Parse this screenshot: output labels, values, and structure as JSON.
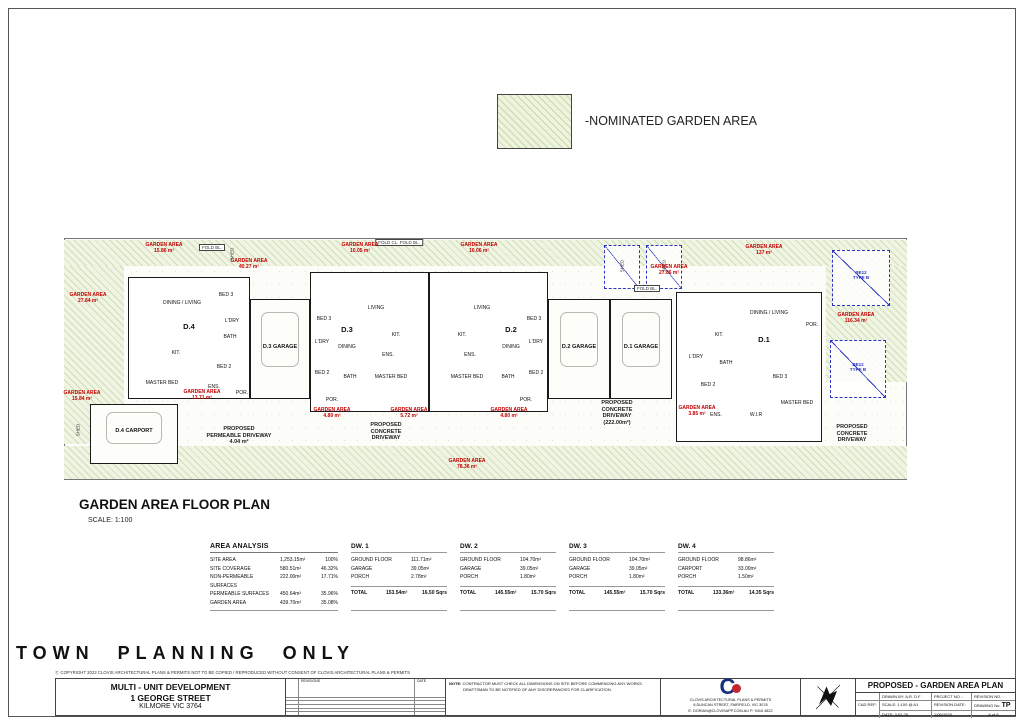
{
  "colors": {
    "garden_hatch": "#eef3e0",
    "hatch_line": "#c7d8a6",
    "label_red": "#c40000",
    "dash_blue": "#2b35c0",
    "wall": "#1a1a1a",
    "logo_navy": "#1b2d7e",
    "logo_red": "#c2262e"
  },
  "legend": {
    "label": "-NOMINATED GARDEN AREA"
  },
  "plan": {
    "heading": "GARDEN AREA FLOOR PLAN",
    "scale_note": "SCALE: 1:100",
    "boxes": [
      {
        "k": "site",
        "x": 0,
        "y": 6,
        "w": 843,
        "h": 242
      },
      {
        "k": "hatch",
        "x": 0,
        "y": 8,
        "w": 843,
        "h": 26
      },
      {
        "k": "hatch",
        "x": 0,
        "y": 34,
        "w": 60,
        "h": 178
      },
      {
        "k": "hatch",
        "x": 0,
        "y": 214,
        "w": 843,
        "h": 33
      },
      {
        "k": "hatch",
        "x": 762,
        "y": 34,
        "w": 81,
        "h": 116
      },
      {
        "k": "unit",
        "x": 64,
        "y": 45,
        "w": 122,
        "h": 122
      },
      {
        "k": "garage",
        "x": 186,
        "y": 67,
        "w": 60,
        "h": 100
      },
      {
        "k": "unit",
        "x": 246,
        "y": 40,
        "w": 119,
        "h": 140
      },
      {
        "k": "unit",
        "x": 365,
        "y": 40,
        "w": 119,
        "h": 140
      },
      {
        "k": "garage",
        "x": 484,
        "y": 67,
        "w": 62,
        "h": 100
      },
      {
        "k": "garage",
        "x": 546,
        "y": 67,
        "w": 62,
        "h": 100
      },
      {
        "k": "unit",
        "x": 612,
        "y": 60,
        "w": 146,
        "h": 150
      },
      {
        "k": "garage",
        "x": 26,
        "y": 172,
        "w": 88,
        "h": 60
      },
      {
        "k": "dashed",
        "x": 540,
        "y": 13,
        "w": 36,
        "h": 44
      },
      {
        "k": "dashed",
        "x": 582,
        "y": 13,
        "w": 36,
        "h": 44
      },
      {
        "k": "dashed",
        "x": 768,
        "y": 18,
        "w": 58,
        "h": 56
      },
      {
        "k": "dashed",
        "x": 766,
        "y": 108,
        "w": 56,
        "h": 58
      }
    ],
    "labels": [
      {
        "t": "FOLD BL.",
        "x": 148,
        "y": 12,
        "c": "fold"
      },
      {
        "t": "FOLD CL.  FOLD BL.",
        "x": 335,
        "y": 7,
        "c": "fold"
      },
      {
        "t": "FOLD BL.",
        "x": 583,
        "y": 53,
        "c": "fold"
      },
      {
        "t": "GARDEN AREA\n15.86 m²",
        "x": 100,
        "y": 10,
        "c": "red"
      },
      {
        "t": "GARDEN AREA\n40.27 m²",
        "x": 185,
        "y": 26,
        "c": "red"
      },
      {
        "t": "GARDEN AREA\n27.84 m²",
        "x": 24,
        "y": 60,
        "c": "red"
      },
      {
        "t": "GARDEN AREA\n10.05 m²",
        "x": 296,
        "y": 10,
        "c": "red"
      },
      {
        "t": "GARDEN AREA\n10.06 m²",
        "x": 415,
        "y": 10,
        "c": "red"
      },
      {
        "t": "GARDEN AREA\n27.86 m²",
        "x": 605,
        "y": 32,
        "c": "red"
      },
      {
        "t": "GARDEN AREA\n137 m²",
        "x": 700,
        "y": 12,
        "c": "red"
      },
      {
        "t": "GARDEN AREA\n116.34 m²",
        "x": 792,
        "y": 80,
        "c": "red"
      },
      {
        "t": "GARDEN AREA\n15.84 m²",
        "x": 18,
        "y": 158,
        "c": "red"
      },
      {
        "t": "GARDEN AREA\n13.71 m²",
        "x": 138,
        "y": 157,
        "c": "red"
      },
      {
        "t": "GARDEN AREA\n4.80 m²",
        "x": 268,
        "y": 175,
        "c": "red"
      },
      {
        "t": "GARDEN AREA\n5.72 m²",
        "x": 345,
        "y": 175,
        "c": "red"
      },
      {
        "t": "GARDEN AREA\n4.80 m²",
        "x": 445,
        "y": 175,
        "c": "red"
      },
      {
        "t": "GARDEN AREA\n3.85 m²",
        "x": 633,
        "y": 173,
        "c": "red"
      },
      {
        "t": "GARDEN AREA\n78.36 m²",
        "x": 403,
        "y": 226,
        "c": "red"
      },
      {
        "t": "D.4",
        "x": 125,
        "y": 90,
        "c": "uid"
      },
      {
        "t": "D.3",
        "x": 283,
        "y": 93,
        "c": "uid"
      },
      {
        "t": "D.2",
        "x": 447,
        "y": 93,
        "c": "uid"
      },
      {
        "t": "D.1",
        "x": 700,
        "y": 103,
        "c": "uid"
      },
      {
        "t": "D.3 GARAGE",
        "x": 216,
        "y": 112,
        "c": "gar"
      },
      {
        "t": "D.2 GARAGE",
        "x": 515,
        "y": 112,
        "c": "gar"
      },
      {
        "t": "D.1 GARAGE",
        "x": 577,
        "y": 112,
        "c": "gar"
      },
      {
        "t": "D.4 CARPORT",
        "x": 70,
        "y": 196,
        "c": "gar"
      },
      {
        "t": "DINING / LIVING",
        "x": 118,
        "y": 68,
        "c": "room"
      },
      {
        "t": "KIT.",
        "x": 112,
        "y": 118,
        "c": "room"
      },
      {
        "t": "MASTER BED",
        "x": 98,
        "y": 148,
        "c": "room"
      },
      {
        "t": "ENS.",
        "x": 150,
        "y": 152,
        "c": "room"
      },
      {
        "t": "BED 3",
        "x": 162,
        "y": 60,
        "c": "room"
      },
      {
        "t": "L'DRY",
        "x": 168,
        "y": 86,
        "c": "room"
      },
      {
        "t": "BATH",
        "x": 166,
        "y": 102,
        "c": "room"
      },
      {
        "t": "BED 2",
        "x": 160,
        "y": 132,
        "c": "room"
      },
      {
        "t": "POR.",
        "x": 178,
        "y": 158,
        "c": "room"
      },
      {
        "t": "LIVING",
        "x": 312,
        "y": 73,
        "c": "room"
      },
      {
        "t": "DINING",
        "x": 283,
        "y": 112,
        "c": "room"
      },
      {
        "t": "KIT.",
        "x": 332,
        "y": 100,
        "c": "room"
      },
      {
        "t": "BED 3",
        "x": 260,
        "y": 84,
        "c": "room"
      },
      {
        "t": "L'DRY",
        "x": 258,
        "y": 107,
        "c": "room"
      },
      {
        "t": "BED 2",
        "x": 258,
        "y": 138,
        "c": "room"
      },
      {
        "t": "BATH",
        "x": 286,
        "y": 142,
        "c": "room"
      },
      {
        "t": "MASTER BED",
        "x": 327,
        "y": 142,
        "c": "room"
      },
      {
        "t": "ENS.",
        "x": 324,
        "y": 120,
        "c": "room"
      },
      {
        "t": "POR.",
        "x": 268,
        "y": 165,
        "c": "room"
      },
      {
        "t": "LIVING",
        "x": 418,
        "y": 73,
        "c": "room"
      },
      {
        "t": "DINING",
        "x": 447,
        "y": 112,
        "c": "room"
      },
      {
        "t": "KIT.",
        "x": 398,
        "y": 100,
        "c": "room"
      },
      {
        "t": "BED 3",
        "x": 470,
        "y": 84,
        "c": "room"
      },
      {
        "t": "L'DRY",
        "x": 472,
        "y": 107,
        "c": "room"
      },
      {
        "t": "BED 2",
        "x": 472,
        "y": 138,
        "c": "room"
      },
      {
        "t": "BATH",
        "x": 444,
        "y": 142,
        "c": "room"
      },
      {
        "t": "MASTER BED",
        "x": 403,
        "y": 142,
        "c": "room"
      },
      {
        "t": "ENS.",
        "x": 406,
        "y": 120,
        "c": "room"
      },
      {
        "t": "POR.",
        "x": 462,
        "y": 165,
        "c": "room"
      },
      {
        "t": "DINING / LIVING",
        "x": 705,
        "y": 78,
        "c": "room"
      },
      {
        "t": "KIT.",
        "x": 655,
        "y": 100,
        "c": "room"
      },
      {
        "t": "L'DRY",
        "x": 632,
        "y": 122,
        "c": "room"
      },
      {
        "t": "BATH",
        "x": 662,
        "y": 128,
        "c": "room"
      },
      {
        "t": "BED 2",
        "x": 644,
        "y": 150,
        "c": "room"
      },
      {
        "t": "BED 3",
        "x": 716,
        "y": 142,
        "c": "room"
      },
      {
        "t": "ENS.",
        "x": 652,
        "y": 180,
        "c": "room"
      },
      {
        "t": "W.I.R",
        "x": 692,
        "y": 180,
        "c": "room"
      },
      {
        "t": "MASTER BED",
        "x": 733,
        "y": 168,
        "c": "room"
      },
      {
        "t": "POR.",
        "x": 748,
        "y": 90,
        "c": "room"
      },
      {
        "t": "SHED",
        "x": 14,
        "y": 198,
        "c": "vert"
      },
      {
        "t": "SHED",
        "x": 168,
        "y": 22,
        "c": "vert"
      },
      {
        "t": "SHED",
        "x": 558,
        "y": 34,
        "c": "vert"
      },
      {
        "t": "SHED",
        "x": 600,
        "y": 34,
        "c": "vert"
      },
      {
        "t": "BE12\nTYPE B",
        "x": 797,
        "y": 38,
        "c": "blue"
      },
      {
        "t": "BE12\nTYPE B",
        "x": 794,
        "y": 130,
        "c": "blue"
      },
      {
        "t": "PROPOSED\nPERMEABLE DRIVEWAY\n4.04 m²",
        "x": 175,
        "y": 194,
        "c": "drv"
      },
      {
        "t": "PROPOSED\nCONCRETE\nDRIVEWAY",
        "x": 322,
        "y": 190,
        "c": "drv"
      },
      {
        "t": "PROPOSED\nCONCRETE\nDRIVEWAY\n(222.00m²)",
        "x": 553,
        "y": 168,
        "c": "drv"
      },
      {
        "t": "PROPOSED\nCONCRETE\nDRIVEWAY",
        "x": 788,
        "y": 192,
        "c": "drv"
      }
    ]
  },
  "analysis": {
    "title": "AREA ANALYSIS",
    "rows": [
      {
        "label": "SITE AREA",
        "area": "1,253.15m²",
        "pct": "100%"
      },
      {
        "label": "SITE COVERAGE",
        "area": "580.51m²",
        "pct": "46.32%"
      },
      {
        "label": "NON-PERMEABLE SURFACES",
        "area": "222.00m²",
        "pct": "17.71%"
      },
      {
        "label": "PERMEABLE SURFACES",
        "area": "450.64m²",
        "pct": "35.96%"
      },
      {
        "label": "GARDEN AREA",
        "area": "439.70m²",
        "pct": "35.08%"
      }
    ]
  },
  "dwellings": [
    {
      "name": "DW. 1",
      "rows": [
        [
          "GROUND FLOOR",
          "111.71m²"
        ],
        [
          "GARAGE",
          "39.05m²"
        ],
        [
          "PORCH",
          "2.78m²"
        ]
      ],
      "total_label": "TOTAL",
      "total": "153.54m²",
      "squares": "16.50 Sqrs"
    },
    {
      "name": "DW. 2",
      "rows": [
        [
          "GROUND FLOOR",
          "104.70m²"
        ],
        [
          "GARAGE",
          "39.05m²"
        ],
        [
          "PORCH",
          "1.80m²"
        ]
      ],
      "total_label": "TOTAL",
      "total": "145.55m²",
      "squares": "15.70 Sqrs"
    },
    {
      "name": "DW. 3",
      "rows": [
        [
          "GROUND FLOOR",
          "104.70m²"
        ],
        [
          "GARAGE",
          "39.05m²"
        ],
        [
          "PORCH",
          "1.80m²"
        ]
      ],
      "total_label": "TOTAL",
      "total": "145.55m²",
      "squares": "15.70 Sqrs"
    },
    {
      "name": "DW. 4",
      "rows": [
        [
          "GROUND FLOOR",
          "98.86m²"
        ],
        [
          "CARPORT",
          "33.00m²"
        ],
        [
          "PORCH",
          "1.50m²"
        ]
      ],
      "total_label": "TOTAL",
      "total": "133.36m²",
      "squares": "14.35 Sqrs"
    }
  ],
  "stamp": "TOWN PLANNING ONLY",
  "copyright": "Ⓒ COPYRIGHT 2022 CLOVIS ARCHITECTURAL PLANS & PERMITS   NOT TO BE COPIED / REPRODUCED WITHOUT CONSENT OF CLOVIS ARCHITECTURAL PLANS & PERMITS",
  "titlebar": {
    "project_lines": [
      "MULTI - UNIT  DEVELOPMENT",
      "1 GEORGE STREET",
      "KILMORE  VIC  3764"
    ],
    "revisions": {
      "header": "REVISIONS",
      "date_header": "DATE",
      "empty_rows": 5
    },
    "note": {
      "label": "NOTE:",
      "line1": "CONTRACTOR MUST CHECK ALL DIMENSIONS ON SITE BEFORE COMMENCING ANY WORKS.",
      "line2": "DRAFTSMAN TO BE NOTIFIED OF ANY DISCREPANCIES FOR CLARIFICATION."
    },
    "company": {
      "name": "CLOVIS ARCHITECTURAL PLANS & PERMITS",
      "address": "8 DUNCAN STREET, FAIRFIELD, VIC 3078",
      "contact": "E: DORIAN@CLOVISAPP.COM.AU  P: 9416 4822"
    },
    "drawing": {
      "title": "PROPOSED - GARDEN AREA PLAN",
      "drawn_by": "DRAWN BY: A.R. D.F",
      "project_no": "PROJECT NO. :",
      "revision_no": "REVISION NO. :",
      "cad_ref": "CAD REF:",
      "scale": "SCALE: 1:100 @ A1",
      "date": "DATE: 3.02.25",
      "revision_date_label": "REVISION DATE:",
      "revision_date": "1/06/2025",
      "drawing_no_label": "DRAWING No:",
      "drawing_no": "TP",
      "sheet": "6 of 9"
    }
  }
}
